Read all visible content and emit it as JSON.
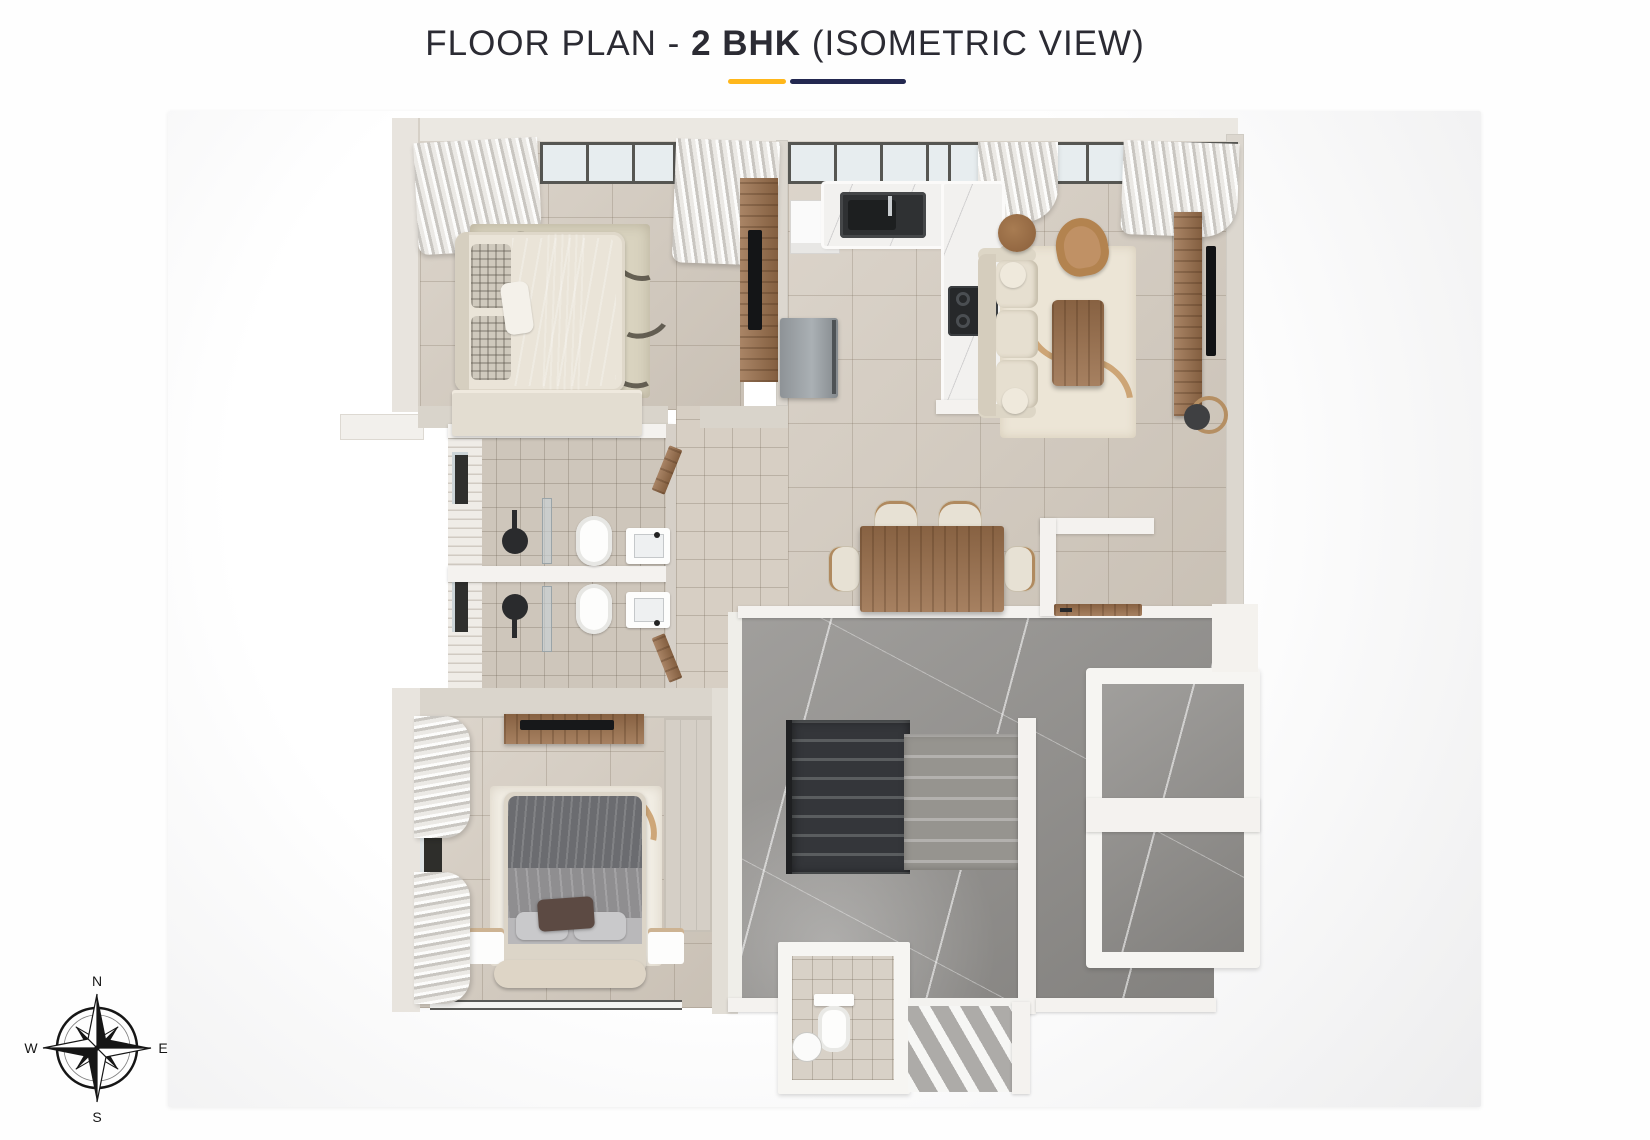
{
  "header": {
    "title_prefix": "FLOOR PLAN - ",
    "title_highlight": "2 BHK",
    "title_suffix": " (ISOMETRIC VIEW)",
    "underline_gold_color": "#FFB71B",
    "underline_navy_color": "#232850",
    "title_text_color": "#2B2B33"
  },
  "compass": {
    "n": "N",
    "e": "E",
    "s": "S",
    "w": "W"
  },
  "palette": {
    "page_bg": "#FEFEFE",
    "card_bg": "#F1F1F2",
    "floor_tile_beige": "#D4CBBF",
    "bath_tile": "#CEC6BB",
    "wall_white": "#F4F2EF",
    "wall_greige": "#DCD7CF",
    "marble_landing_gray": "#918F8C",
    "marble_counter_white": "#F2F1EF",
    "wood_brown": "#9A6F4B",
    "stair_dark": "#3A3C3E",
    "stair_light": "#9B9995",
    "fixture_black": "#26282A",
    "fabric_cream": "#E6DFD0",
    "fabric_gray": "#85898F"
  }
}
